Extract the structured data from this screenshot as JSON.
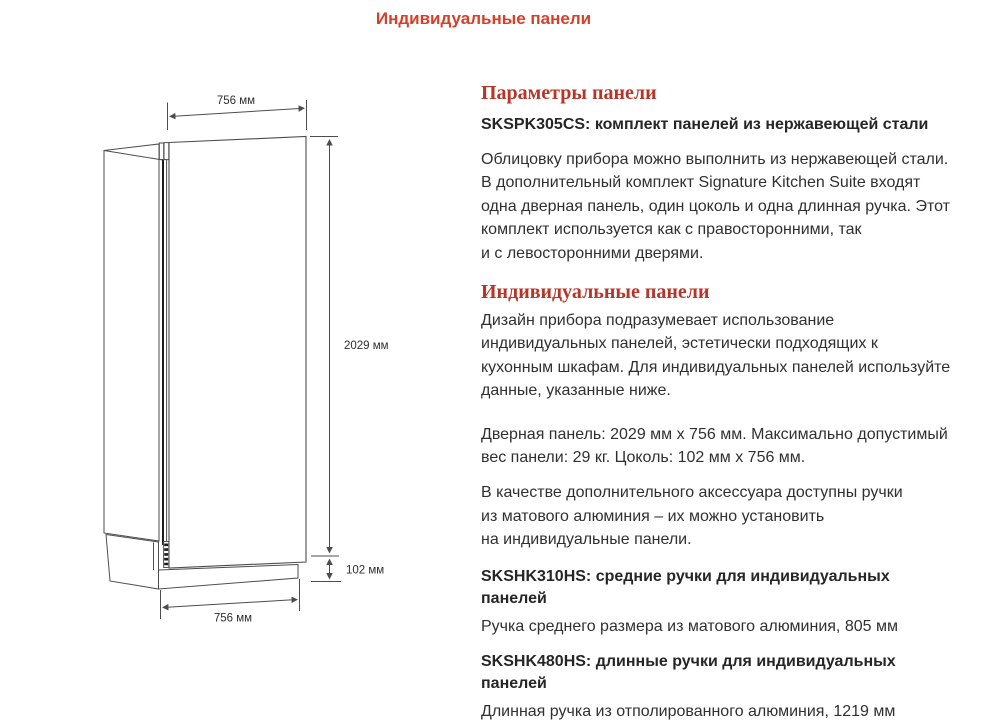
{
  "colors": {
    "title_red": "#d6402a",
    "heading_red": "#b53629",
    "text": "#303030",
    "line": "#4d4d4d"
  },
  "page": {
    "title": "Индивидуальные панели"
  },
  "diagram": {
    "top_width_label": "756 мм",
    "height_label": "2029 мм",
    "plinth_height_label": "102 мм",
    "bottom_width_label": "756 мм"
  },
  "content": {
    "params_heading": "Параметры панели",
    "params_product": "SKSPK305CS: комплект панелей из нержавеющей стали",
    "params_body": "Облицовку прибора можно выполнить из нержавеющей стали.\nВ дополнительный комплект Signature Kitchen Suite входят\nодна дверная панель, один цоколь и одна длинная ручка. Этот\nкомплект используется как с правосторонними, так\nи с левосторонними дверями.",
    "custom_heading": "Индивидуальные панели",
    "custom_body": "Дизайн прибора подразумевает использование\nиндивидуальных панелей, эстетически подходящих к\nкухонным шкафам. Для индивидуальных панелей используйте\nданные, указанные ниже.",
    "dimensions_body": "Дверная панель: 2029 мм x 756 мм. Максимально допустимый\nвес панели: 29 кг. Цоколь: 102 мм x 756 мм.",
    "handles_body": "В качестве дополнительного аксессуара доступны ручки\nиз матового алюминия – их можно установить\nна индивидуальные панели.",
    "handle_mid_title": "SKSHK310HS: средние ручки для индивидуальных панелей",
    "handle_mid_desc": "Ручка среднего размера из матового алюминия, 805 мм",
    "handle_long_title": "SKSHK480HS: длинные ручки для индивидуальных панелей",
    "handle_long_desc": "Длинная ручка из отполированного алюминия, 1219 мм"
  }
}
